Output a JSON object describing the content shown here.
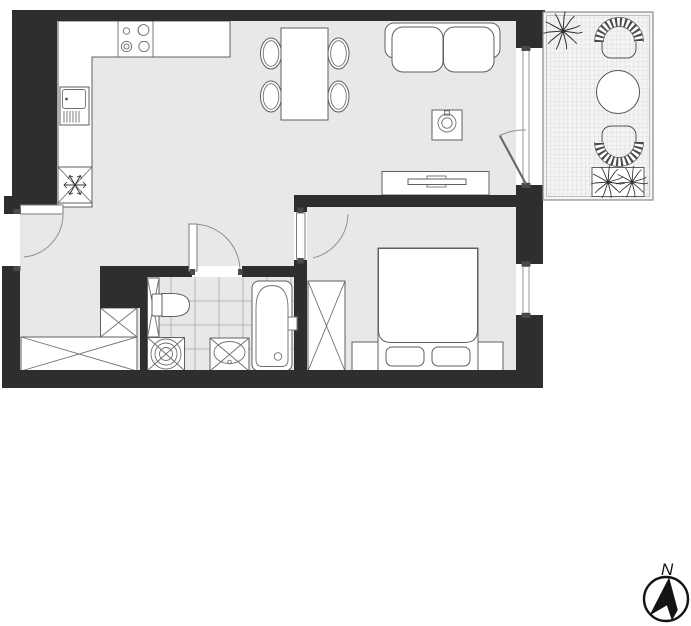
{
  "compass": {
    "north_label": "N"
  },
  "palette": {
    "wall": "#2e2e2e",
    "floor": "#e8e8e8",
    "balcony_slab": "#f4f4f4",
    "balcony_grid": "#cccccc",
    "tile_line": "#a8a8a8",
    "furniture_fill": "#ffffff",
    "furniture_stroke": "#5f5f5f",
    "door_arc": "#909090"
  },
  "areas": {
    "kitchen": {
      "symbols": [
        "cooktop-icon",
        "kitchen-sink-icon",
        "refrigerator-icon"
      ]
    },
    "living_dining": {
      "symbols": [
        "dining-table-icon",
        "chair-icon",
        "sofa-icon",
        "coffee-table-icon",
        "plant-icon",
        "tv-sideboard-icon"
      ]
    },
    "hallway": {
      "symbols": [
        "entrance-door-icon",
        "wardrobe-icon"
      ]
    },
    "bathroom": {
      "symbols": [
        "toilet-icon",
        "shelf-icon",
        "washing-machine-icon",
        "washbasin-icon",
        "bathtub-icon"
      ]
    },
    "bedroom": {
      "symbols": [
        "double-bed-icon",
        "pillow-icon",
        "nightstand-icon",
        "wardrobe-icon",
        "window-icon"
      ]
    },
    "balcony": {
      "symbols": [
        "armchair-icon",
        "round-table-icon",
        "plant-icon",
        "planter-icon"
      ]
    }
  }
}
